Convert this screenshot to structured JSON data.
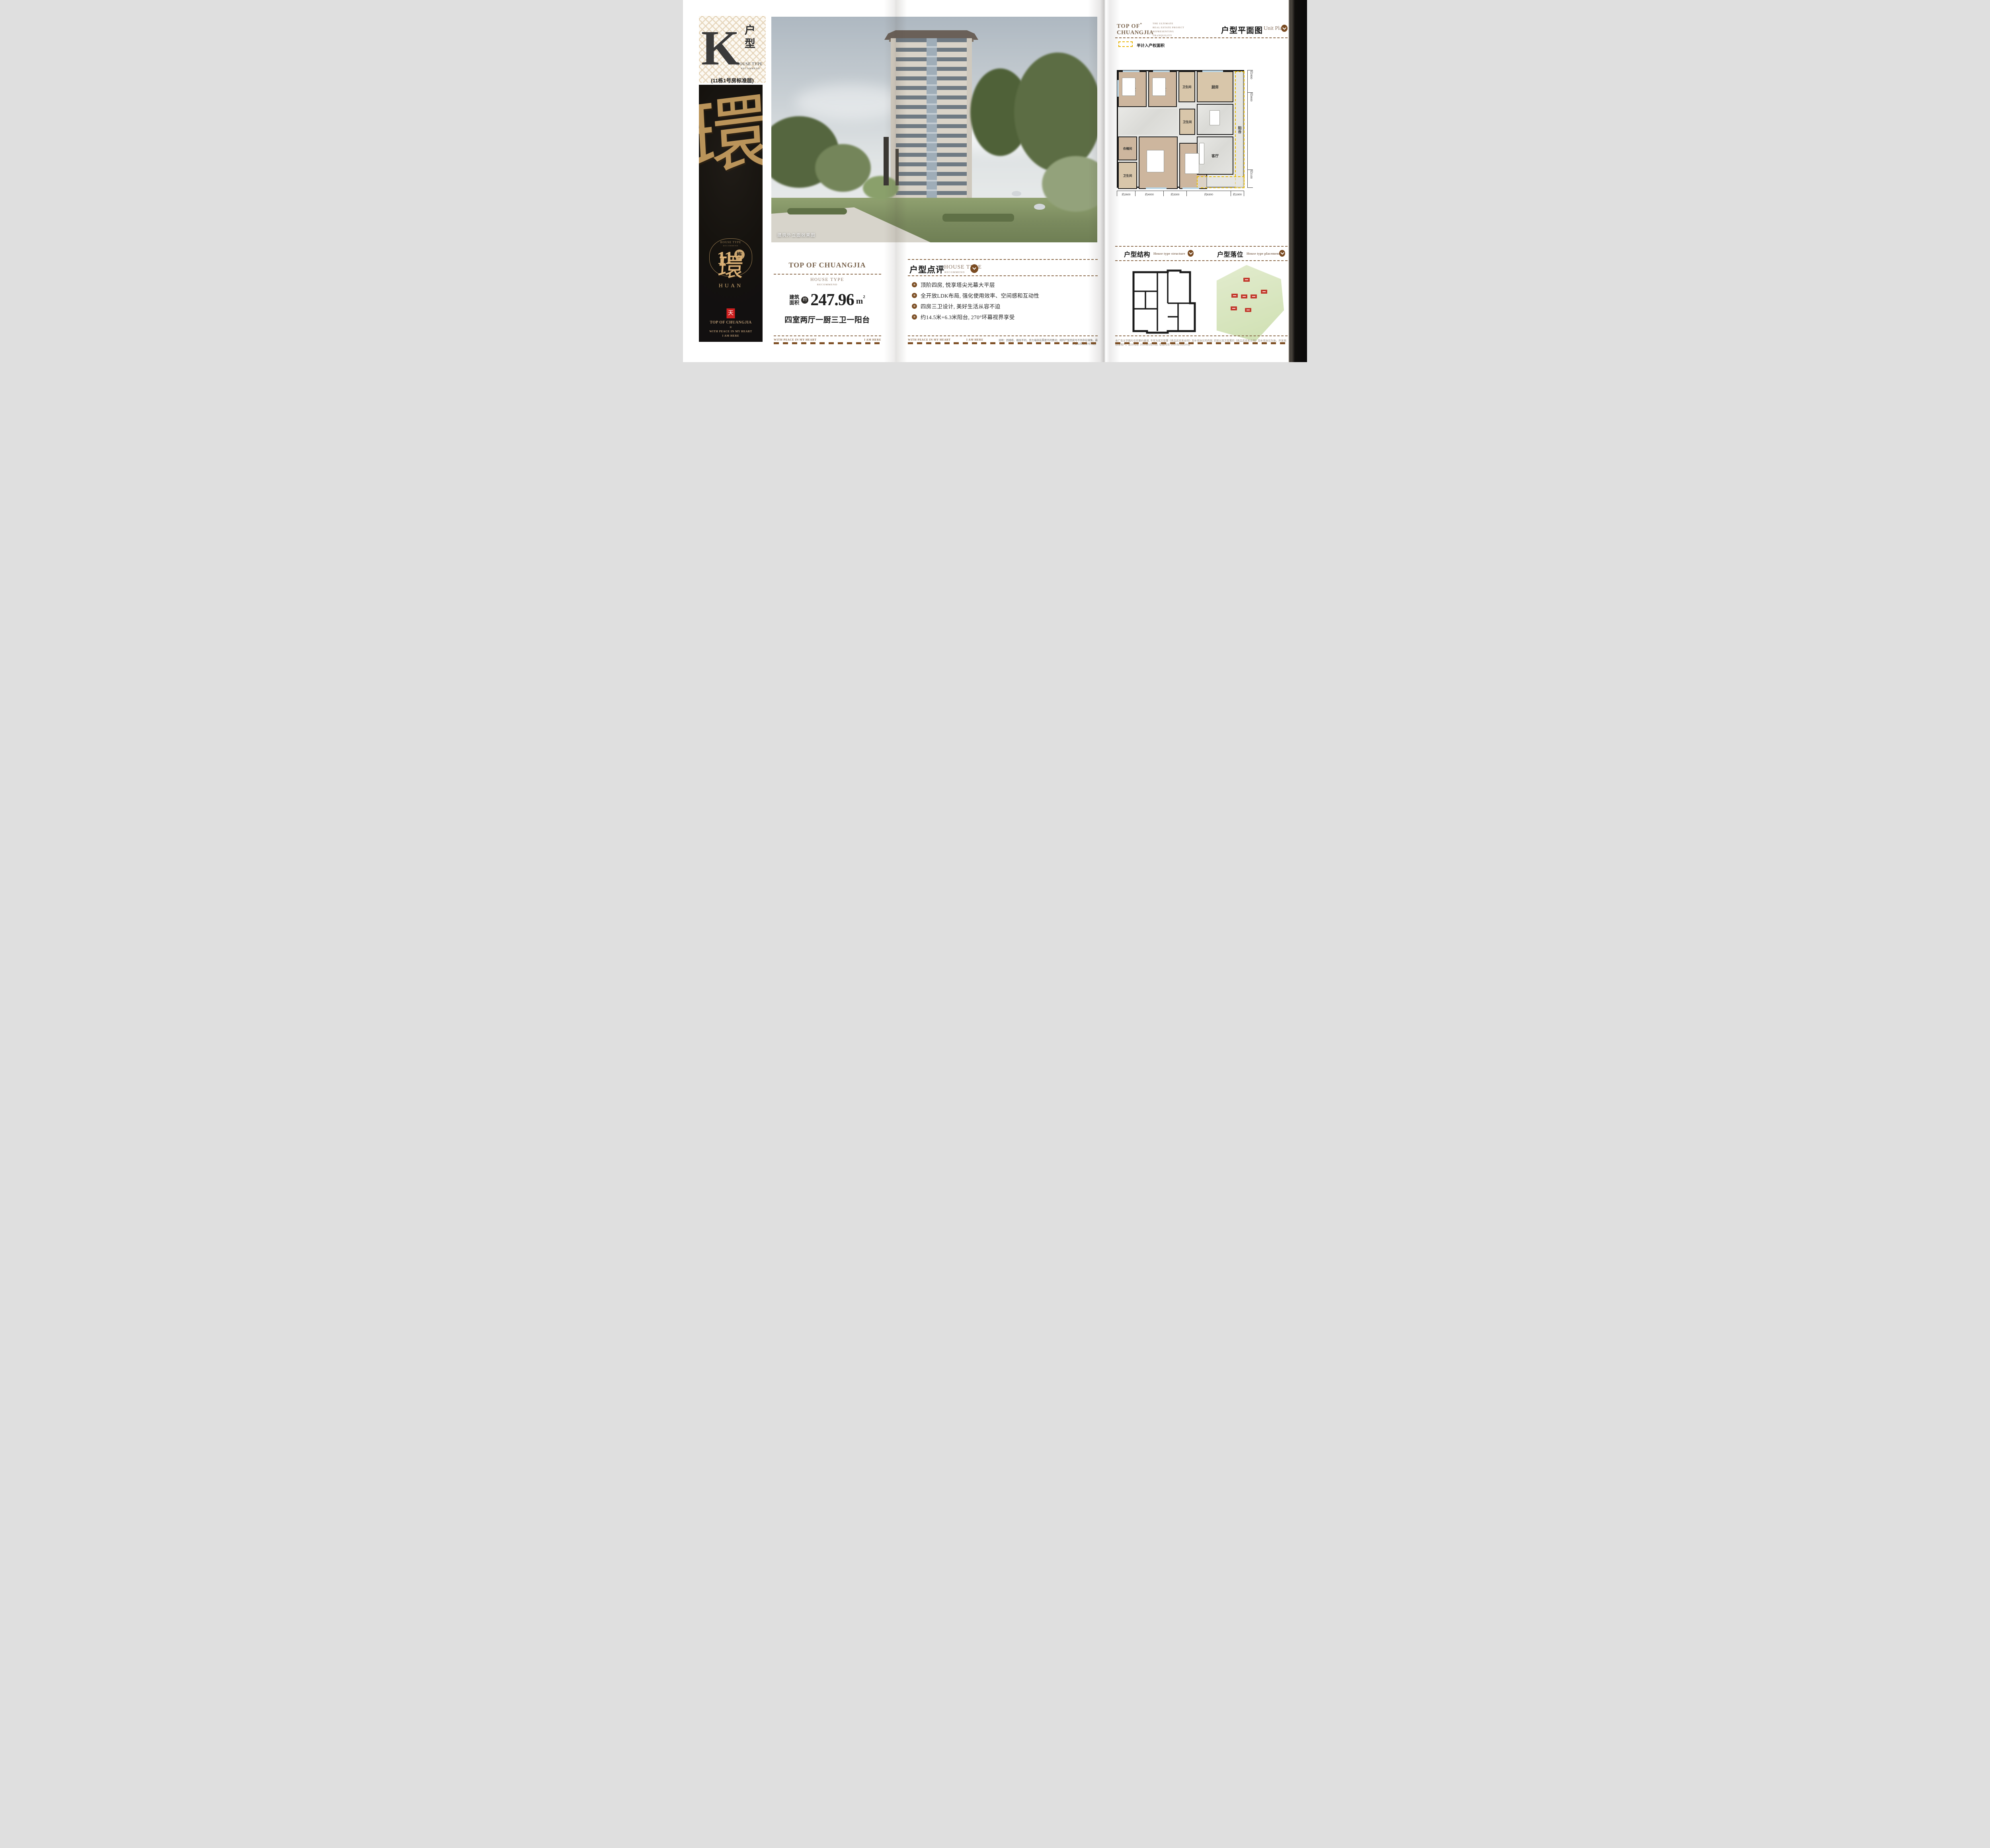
{
  "badge": {
    "letter": "K",
    "hz1": "户",
    "hz2": "型",
    "en": "HOUSE TYPE",
    "en_sub": "RECOMMEND",
    "note": "(11栋1号房标准层)"
  },
  "banner": {
    "art": "環",
    "frame_en": "HOUSE TYPE",
    "frame_sub": "RECOMMEND",
    "number": "11",
    "number_suffix": "栋",
    "calligraphy": "環",
    "pinyin": "HUAN",
    "seal": "天",
    "brand": "TOP OF CHUANGJIA",
    "ornament": "✳",
    "motto_line1": "WITH PEACE IN MY HEART",
    "motto_line2": "I AM HERE"
  },
  "photo": {
    "caption": "建筑外立面效果图"
  },
  "summary": {
    "brand": "TOP OF CHUANGJIA",
    "en": "HOUSE TYPE",
    "en_sub": "RECOMMEND",
    "area_label1": "建筑",
    "area_label2": "面积",
    "approx": "约",
    "area": "247.96",
    "unit": "m",
    "sup": "2",
    "layout": "四室两厅一厨三卫一阳台"
  },
  "footer": {
    "left": "WITH PEACE IN MY HEART",
    "right": "I AM HERE"
  },
  "review": {
    "title": "户型点评",
    "en": "HOUSE TYPE",
    "en_sub": "RECOMMEND",
    "bullet_glyph": "✳",
    "bullets": [
      "顶阶四房, 悦享塔尖光幕大平层",
      "全开放LDK布局, 强化使用效率、空间感和互动性",
      "四房三卫设计, 美好生活从容不迫",
      "约14.5米+6.3米阳台, 270°环幕视界享受"
    ],
    "note": "说明：因楼栋、楼层不同，剪力墙存在厚度不同情况；相同户型因房号不同存在镜像。最终请以实际交付为准。"
  },
  "plan_page": {
    "logo_line1": "TOP OF",
    "logo_star": "*",
    "logo_line2": "CHUANGJIA",
    "tagline1": "THE ULTIMATE",
    "tagline2": "REAL ESTATE PROJECT",
    "tagline3": "REPRESENTING",
    "tagline4": "TRANQUILITY",
    "title": "户型平面图",
    "title_en": "Unit Plan",
    "legend": "半计入产权面积",
    "rooms": {
      "bed1": "卧室",
      "bed2": "卧室",
      "bath1": "卫生间",
      "kitchen": "厨房",
      "dining": "餐厅",
      "cloak": "衣帽间",
      "bath2": "卫生间",
      "master": "主卧",
      "bed3": "卧室",
      "bath3": "卫生间",
      "living": "客厅",
      "balcony": "阳台"
    },
    "dims_bottom": [
      "约2600",
      "约4000",
      "约3300",
      "约6300",
      "约1900"
    ],
    "dims_right": [
      "约2800",
      "约9600",
      "约2100"
    ],
    "structure_title": "户型结构",
    "structure_en": "House type structure",
    "placement_title": "户型落位",
    "placement_en": "House type placement",
    "disclaimer": "本广告文字图片仅作要约邀请, 不作为双方签署《商品房买卖合同》及补充协议的内容, 实际以双方签署的《商品房买卖合同》及补充协议为准。开发商: 创佳地产。设计时间: 2025年5月20日; 有效时间: 2025年12月30日"
  },
  "colors": {
    "accent_brown": "#7a4b22",
    "text_brown": "#8a7360",
    "gold": "#c9a46e",
    "dash_brown": "#8a6848",
    "dash_dark": "#7d4e22",
    "legend_yellow": "#e8b400",
    "seal_red": "#ce2020",
    "site_green": "#dbe9c6",
    "block_red": "#c2392b"
  }
}
